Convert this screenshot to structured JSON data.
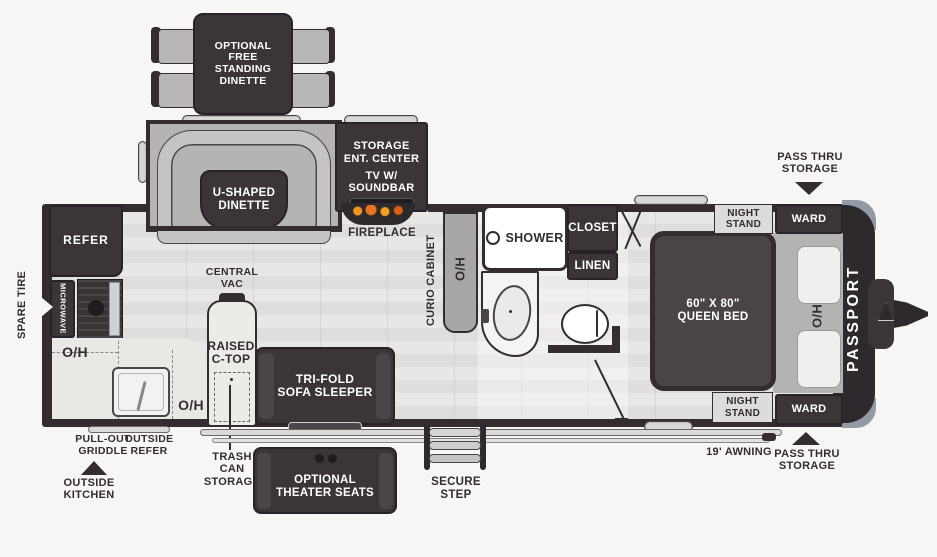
{
  "diagram_type": "travel-trailer-floorplan",
  "brand": "PASSPORT",
  "colors": {
    "background": "#f8f6f4",
    "furniture_dark": "#3b3538",
    "wall": "#332d30",
    "slide_gray": "#b6b4b2",
    "bench_gray": "#c6c4c2",
    "floor_light": "#e6e4e2",
    "counter": "#eae8e5",
    "front_cap_accent": "#929aa6",
    "flame_orange": "#e8741f",
    "label_text": "#332d30",
    "white": "#ffffff"
  },
  "labels": {
    "optional_dinette": "OPTIONAL\nFREE\nSTANDING\nDINETTE",
    "storage": "STORAGE",
    "ent_center": "ENT. CENTER",
    "tv_soundbar": "TV W/\nSOUNDBAR",
    "fireplace": "FIREPLACE",
    "u_dinette": "U-SHAPED\nDINETTE",
    "pass_thru": "PASS THRU\nSTORAGE",
    "refer": "REFER",
    "microwave": "MICROWAVE",
    "spare_tire": "SPARE TIRE",
    "oh": "O/H",
    "central_vac": "CENTRAL\nVAC",
    "raised_ctop": "RAISED\nC-TOP",
    "trash_can_storage": "TRASH\nCAN\nSTORAGE",
    "sofa": "TRI-FOLD\nSOFA SLEEPER",
    "curio_cabinet": "CURIO CABINET",
    "shower": "SHOWER",
    "closet": "CLOSET",
    "linen": "LINEN",
    "night_stand": "NIGHT\nSTAND",
    "ward": "WARD",
    "queen_bed": "60\" X 80\"\nQUEEN BED",
    "passport": "PASSPORT",
    "pull_out_griddle": "PULL-OUT\nGRIDDLE",
    "outside_refer": "OUTSIDE\nREFER",
    "outside_kitchen": "OUTSIDE\nKITCHEN",
    "theater_seats": "OPTIONAL\nTHEATER SEATS",
    "secure_step": "SECURE STEP",
    "awning": "19' AWNING"
  }
}
